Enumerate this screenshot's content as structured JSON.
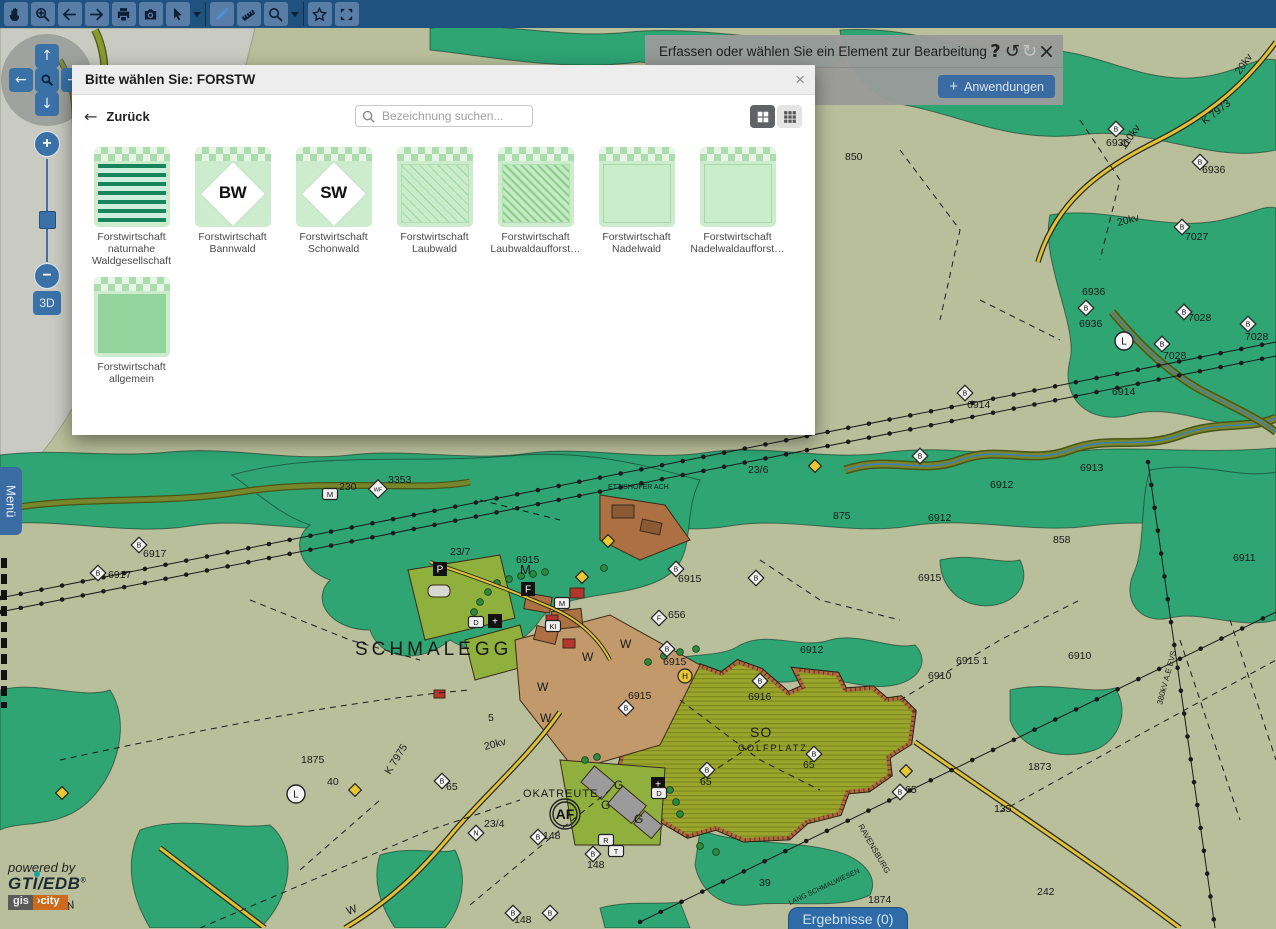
{
  "colors": {
    "toolbar_bg": "#20527f",
    "button_blue": "#3a72a8",
    "accent_blue": "#3a6ca3",
    "forest_green": "#2ea573",
    "map_olive": "#b9bf9b",
    "golf_olive": "#9aa52c",
    "road_yellow": "#e2c235"
  },
  "toolbar": {
    "buttons": [
      {
        "icon": "hand-tool"
      },
      {
        "icon": "zoom-in-tool"
      },
      {
        "icon": "back-arrow"
      },
      {
        "icon": "forward-arrow"
      },
      {
        "icon": "print"
      },
      {
        "icon": "screenshot"
      },
      {
        "icon": "select-cursor",
        "dropdown": true,
        "divider_after": true
      },
      {
        "icon": "draw-pencil",
        "active": true
      },
      {
        "icon": "measure-ruler"
      },
      {
        "icon": "search",
        "dropdown": true,
        "divider_after": true
      },
      {
        "icon": "favorites-star"
      },
      {
        "icon": "fullscreen"
      }
    ]
  },
  "message_bar": {
    "text": "Erfassen oder wählen Sie ein Element zur Bearbeitung",
    "help": "?",
    "undo": "↺",
    "redo": "↻",
    "close": "×"
  },
  "apps_button": {
    "plus": "+",
    "label": "Anwendungen"
  },
  "dialog": {
    "title": "Bitte wählen Sie: FORSTW",
    "close": "×",
    "back_arrow": "←",
    "back_label": "Zurück",
    "search_placeholder": "Bezeichnung suchen...",
    "tiles": [
      {
        "label": "Forstwirtschaft naturnahe Waldgesellschaft",
        "pattern": "stripes"
      },
      {
        "label": "Forstwirtschaft Bannwald",
        "pattern": "diamond",
        "badge": "BW"
      },
      {
        "label": "Forstwirtschaft Schonwald",
        "pattern": "diamond",
        "badge": "SW"
      },
      {
        "label": "Forstwirtschaft Laubwald",
        "pattern": "hatch"
      },
      {
        "label": "Forstwirtschaft Laubwaldaufforst…",
        "pattern": "hatchdense"
      },
      {
        "label": "Forstwirtschaft Nadelwald",
        "pattern": "outline"
      },
      {
        "label": "Forstwirtschaft Nadelwaldaufforst…",
        "pattern": "outline"
      },
      {
        "label": "Forstwirtschaft allgemein",
        "pattern": "solid"
      }
    ]
  },
  "left_controls": {
    "up": "↑",
    "left": "←",
    "down": "↓",
    "right": "→",
    "zoom_in": "+",
    "zoom_out": "−",
    "three_d": "3D",
    "menu": "Menü"
  },
  "results_button": {
    "label": "Ergebnisse (0)"
  },
  "branding": {
    "powered_by": "powered by",
    "brand": "GTI/EDB",
    "reg": "®",
    "badge_left": "gis",
    "badge_right": "›city"
  },
  "map": {
    "labels": [
      {
        "t": "SCHMALEGG",
        "x": 355,
        "y": 655,
        "s": 19,
        "ls": 4
      },
      {
        "t": "OKATREUTE",
        "x": 523,
        "y": 797,
        "s": 11,
        "ls": 1
      },
      {
        "t": "SO",
        "x": 750,
        "y": 737,
        "s": 14,
        "ls": 1
      },
      {
        "t": "GOLFPLATZ",
        "x": 738,
        "y": 751,
        "s": 9,
        "ls": 2
      },
      {
        "t": "ETTISHOFER ACH",
        "x": 608,
        "y": 489,
        "s": 7
      },
      {
        "t": "6915",
        "x": 516,
        "y": 563
      },
      {
        "t": "6915",
        "x": 678,
        "y": 582
      },
      {
        "t": "6915",
        "x": 628,
        "y": 699
      },
      {
        "t": "6915",
        "x": 663,
        "y": 665
      },
      {
        "t": "6915 1",
        "x": 956,
        "y": 664
      },
      {
        "t": "6916",
        "x": 748,
        "y": 700
      },
      {
        "t": "6915",
        "x": 918,
        "y": 581
      },
      {
        "t": "65",
        "x": 803,
        "y": 768
      },
      {
        "t": "65",
        "x": 700,
        "y": 785
      },
      {
        "t": "65",
        "x": 905,
        "y": 793
      },
      {
        "t": "65",
        "x": 446,
        "y": 790
      },
      {
        "t": "23/4",
        "x": 484,
        "y": 827
      },
      {
        "t": "148",
        "x": 543,
        "y": 839
      },
      {
        "t": "148",
        "x": 587,
        "y": 868
      },
      {
        "t": "148",
        "x": 514,
        "y": 923
      },
      {
        "t": "6917",
        "x": 143,
        "y": 557
      },
      {
        "t": "6917",
        "x": 108,
        "y": 578
      },
      {
        "t": "3353",
        "x": 388,
        "y": 483
      },
      {
        "t": "230",
        "x": 339,
        "y": 490
      },
      {
        "t": "6936",
        "x": 1106,
        "y": 146
      },
      {
        "t": "6936",
        "x": 1202,
        "y": 173
      },
      {
        "t": "7027",
        "x": 1185,
        "y": 240
      },
      {
        "t": "7028",
        "x": 1188,
        "y": 321
      },
      {
        "t": "7028",
        "x": 1163,
        "y": 359
      },
      {
        "t": "7028",
        "x": 1245,
        "y": 340
      },
      {
        "t": "850",
        "x": 845,
        "y": 160
      },
      {
        "t": "875",
        "x": 833,
        "y": 519
      },
      {
        "t": "858",
        "x": 1053,
        "y": 543
      },
      {
        "t": "6913",
        "x": 1080,
        "y": 471
      },
      {
        "t": "6912",
        "x": 990,
        "y": 488
      },
      {
        "t": "6912",
        "x": 928,
        "y": 521
      },
      {
        "t": "6912",
        "x": 800,
        "y": 653
      },
      {
        "t": "6911",
        "x": 1233,
        "y": 561
      },
      {
        "t": "6910",
        "x": 1068,
        "y": 659
      },
      {
        "t": "6910",
        "x": 928,
        "y": 679
      },
      {
        "t": "6914",
        "x": 967,
        "y": 408
      },
      {
        "t": "6914",
        "x": 1112,
        "y": 395
      },
      {
        "t": "6936",
        "x": 1082,
        "y": 295
      },
      {
        "t": "6936",
        "x": 1079,
        "y": 327
      },
      {
        "t": "1875",
        "x": 301,
        "y": 763
      },
      {
        "t": "1873",
        "x": 1028,
        "y": 770
      },
      {
        "t": "135",
        "x": 994,
        "y": 812
      },
      {
        "t": "23/7",
        "x": 450,
        "y": 555
      },
      {
        "t": "23/6",
        "x": 748,
        "y": 473
      },
      {
        "t": "5",
        "x": 488,
        "y": 721
      },
      {
        "t": "39",
        "x": 759,
        "y": 886
      },
      {
        "t": "242",
        "x": 1037,
        "y": 895
      },
      {
        "t": "1874",
        "x": 868,
        "y": 903
      },
      {
        "t": "40",
        "x": 327,
        "y": 785
      },
      {
        "t": "656",
        "x": 668,
        "y": 618
      },
      {
        "t": "M",
        "x": 520,
        "y": 574,
        "s": 13
      },
      {
        "t": "W",
        "x": 620,
        "y": 648,
        "s": 12
      },
      {
        "t": "W",
        "x": 582,
        "y": 661,
        "s": 12
      },
      {
        "t": "W",
        "x": 537,
        "y": 691,
        "s": 12
      },
      {
        "t": "W",
        "x": 540,
        "y": 722,
        "s": 12
      },
      {
        "t": "W",
        "x": 348,
        "y": 915,
        "s": 11,
        "r": -20
      },
      {
        "t": "W",
        "x": 66,
        "y": 911,
        "s": 11,
        "r": -20
      },
      {
        "t": "G",
        "x": 614,
        "y": 789,
        "s": 12
      },
      {
        "t": "G",
        "x": 601,
        "y": 809,
        "s": 12
      },
      {
        "t": "G",
        "x": 634,
        "y": 823,
        "s": 12
      },
      {
        "t": "K 7975",
        "x": 390,
        "y": 775,
        "r": -58
      },
      {
        "t": "K 7973",
        "x": 1205,
        "y": 125,
        "r": -38
      },
      {
        "t": "20kv",
        "x": 1240,
        "y": 75,
        "r": -55
      },
      {
        "t": "20kv",
        "x": 1118,
        "y": 226,
        "r": -14
      },
      {
        "t": "20kv",
        "x": 485,
        "y": 750,
        "r": -14
      },
      {
        "t": "110kv",
        "x": 1125,
        "y": 150,
        "r": -55
      },
      {
        "t": "380kV A.E EVS",
        "x": 1162,
        "y": 705,
        "r": -75,
        "s": 8
      },
      {
        "t": "RAVENSBURG",
        "x": 858,
        "y": 826,
        "r": 60,
        "s": 8
      },
      {
        "t": "LANG SCHMALWIESEN",
        "x": 790,
        "y": 905,
        "r": -25,
        "s": 7
      }
    ],
    "markers": [
      {
        "k": "sq-b",
        "t": "P",
        "x": 440,
        "y": 569
      },
      {
        "k": "sq-b",
        "t": "F",
        "x": 528,
        "y": 589
      },
      {
        "k": "sq-b",
        "t": "+",
        "x": 495,
        "y": 621
      },
      {
        "k": "sq-b",
        "t": "+",
        "x": 658,
        "y": 784
      },
      {
        "k": "sq-w",
        "t": "M",
        "x": 562,
        "y": 603
      },
      {
        "k": "sq-w",
        "t": "KI",
        "x": 553,
        "y": 626
      },
      {
        "k": "sq-w",
        "t": "D",
        "x": 476,
        "y": 622
      },
      {
        "k": "sq-w",
        "t": "D",
        "x": 659,
        "y": 793
      },
      {
        "k": "sq-w",
        "t": "R",
        "x": 606,
        "y": 840
      },
      {
        "k": "sq-w",
        "t": "T",
        "x": 616,
        "y": 851
      },
      {
        "k": "sq-w",
        "t": "M",
        "x": 330,
        "y": 494
      },
      {
        "k": "d",
        "t": "B",
        "x": 1116,
        "y": 129
      },
      {
        "k": "d",
        "t": "B",
        "x": 1200,
        "y": 162
      },
      {
        "k": "d",
        "t": "B",
        "x": 1182,
        "y": 227
      },
      {
        "k": "d",
        "t": "B",
        "x": 1184,
        "y": 312
      },
      {
        "k": "d",
        "t": "B",
        "x": 1162,
        "y": 344
      },
      {
        "k": "d",
        "t": "B",
        "x": 1248,
        "y": 324
      },
      {
        "k": "d",
        "t": "B",
        "x": 139,
        "y": 545
      },
      {
        "k": "d",
        "t": "B",
        "x": 98,
        "y": 573
      },
      {
        "k": "d",
        "t": "WF",
        "x": 378,
        "y": 489
      },
      {
        "k": "d",
        "t": "B",
        "x": 676,
        "y": 569
      },
      {
        "k": "d",
        "t": "F",
        "x": 659,
        "y": 618
      },
      {
        "k": "d",
        "t": "B",
        "x": 667,
        "y": 649
      },
      {
        "k": "d",
        "t": "B",
        "x": 626,
        "y": 708
      },
      {
        "k": "d",
        "t": "B",
        "x": 760,
        "y": 681
      },
      {
        "k": "d",
        "t": "B",
        "x": 814,
        "y": 754
      },
      {
        "k": "d",
        "t": "B",
        "x": 707,
        "y": 770
      },
      {
        "k": "d",
        "t": "B",
        "x": 900,
        "y": 792
      },
      {
        "k": "d",
        "t": "B",
        "x": 442,
        "y": 781
      },
      {
        "k": "d",
        "t": "N",
        "x": 476,
        "y": 833
      },
      {
        "k": "d",
        "t": "B",
        "x": 538,
        "y": 837
      },
      {
        "k": "d",
        "t": "B",
        "x": 593,
        "y": 854
      },
      {
        "k": "d",
        "t": "B",
        "x": 513,
        "y": 913
      },
      {
        "k": "d",
        "t": "B",
        "x": 550,
        "y": 913
      },
      {
        "k": "d",
        "t": "B",
        "x": 920,
        "y": 456
      },
      {
        "k": "d",
        "t": "B",
        "x": 1086,
        "y": 308
      },
      {
        "k": "d",
        "t": "B",
        "x": 965,
        "y": 393
      },
      {
        "k": "d",
        "t": "B",
        "x": 756,
        "y": 578
      },
      {
        "k": "c",
        "t": "L",
        "x": 1124,
        "y": 341
      },
      {
        "k": "c",
        "t": "L",
        "x": 296,
        "y": 794
      },
      {
        "k": "cy",
        "t": "H",
        "x": 685,
        "y": 676
      },
      {
        "k": "caf",
        "t": "AF",
        "x": 565,
        "y": 814
      },
      {
        "k": "dy",
        "x": 815,
        "y": 466
      },
      {
        "k": "dy",
        "x": 608,
        "y": 541
      },
      {
        "k": "dy",
        "x": 582,
        "y": 577
      },
      {
        "k": "dy",
        "x": 906,
        "y": 771
      },
      {
        "k": "dy",
        "x": 355,
        "y": 790
      },
      {
        "k": "dy",
        "x": 62,
        "y": 793
      }
    ]
  }
}
